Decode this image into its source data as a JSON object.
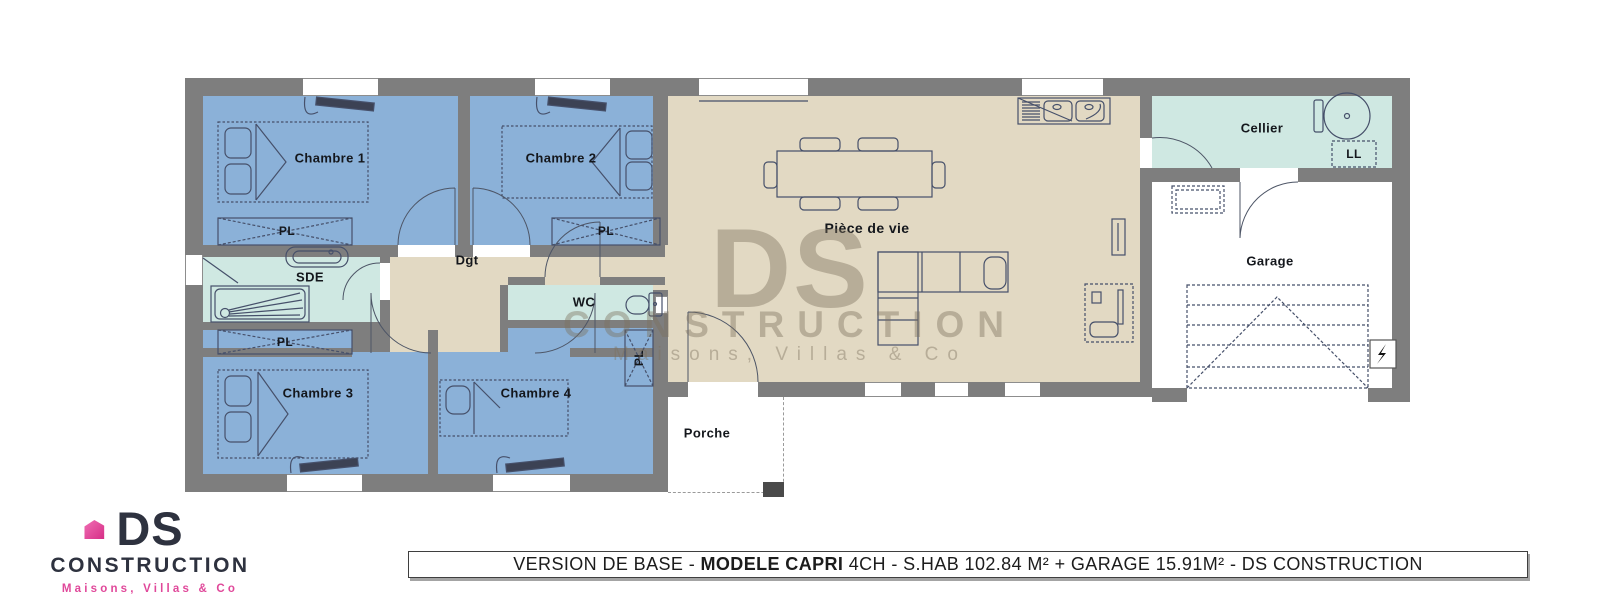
{
  "colors": {
    "wall": "#7e7e7e",
    "bedroom": "#8bb1d8",
    "wetroom": "#cfe8e2",
    "living": "#e2d9c3",
    "brand_dark": "#2e323f",
    "brand_pink": "#e0489a",
    "watermark_color": "rgba(124,112,92,0.42)"
  },
  "plan": {
    "rooms": [
      {
        "id": "chambre-1",
        "label": "Chambre 1"
      },
      {
        "id": "chambre-2",
        "label": "Chambre 2"
      },
      {
        "id": "chambre-3",
        "label": "Chambre 3"
      },
      {
        "id": "chambre-4",
        "label": "Chambre 4"
      },
      {
        "id": "sde",
        "label": "SDE"
      },
      {
        "id": "wc",
        "label": "WC"
      },
      {
        "id": "dgt",
        "label": "Dgt"
      },
      {
        "id": "piece-de-vie",
        "label": "Pièce de vie"
      },
      {
        "id": "cellier",
        "label": "Cellier"
      },
      {
        "id": "garage",
        "label": "Garage"
      },
      {
        "id": "porche",
        "label": "Porche"
      }
    ],
    "closet_label": "PL",
    "washer_label": "LL"
  },
  "watermark": {
    "brand": "DS",
    "company": "CONSTRUCTION",
    "tagline": "Maisons, Villas & Co"
  },
  "logo": {
    "brand": "DS",
    "company": "CONSTRUCTION",
    "tagline": "Maisons, Villas & Co"
  },
  "banner": {
    "part1": "VERSION DE BASE - ",
    "model": "MODELE CAPRI",
    "part2": " 4CH - S.HAB 102.84 M² + GARAGE 15.91M² - DS CONSTRUCTION"
  }
}
